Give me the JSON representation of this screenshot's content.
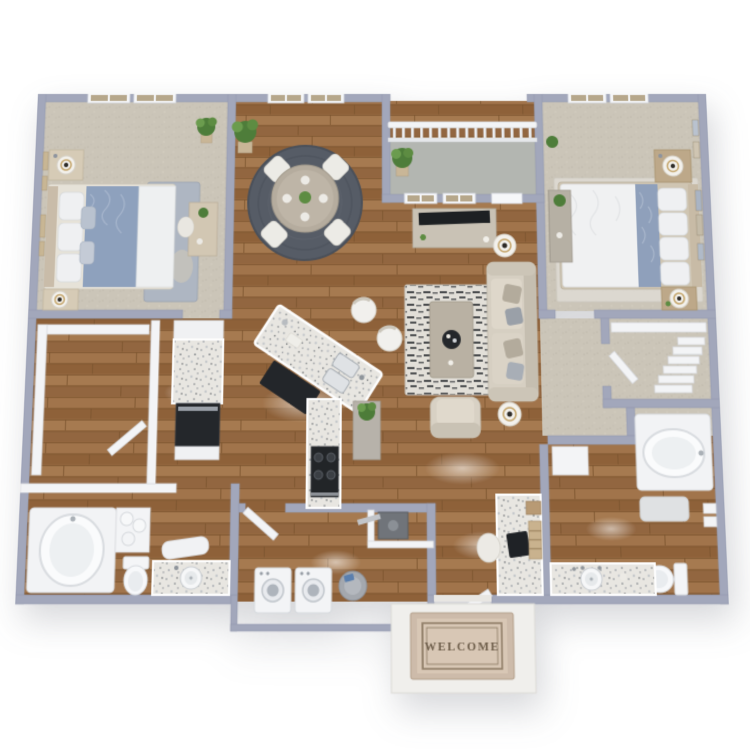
{
  "page": {
    "description": "3D isometric rendering of a two-bedroom two-bathroom apartment floor plan on a white background",
    "background_color": "#ffffff"
  },
  "floor_plan": {
    "name": "two-bed-two-bath-apartment-3d-floor-plan",
    "bedrooms": 2,
    "bathrooms": 2,
    "welcome_mat": {
      "text": "WELCOME"
    },
    "colors": {
      "exterior_wall": "#a2a7bb",
      "interior_wall": "#f3f4f6",
      "wood_floor": "#9a6c43",
      "carpet": "#cbc5b8",
      "balcony_concrete": "#b3b6b1",
      "granite_counter": "#e8e6e1",
      "dining_rug": "#565c66",
      "living_rug_dark": "#2f3236",
      "bedding_accent_blue": "#8ea1bd",
      "appliance_black": "#23262b",
      "welcome_mat_tan": "#d8c7b5",
      "plant_green": "#4e7d3a"
    },
    "rooms": [
      {
        "id": "bedroom-1",
        "name": "Bedroom 1",
        "floor": "carpet",
        "furniture": [
          "queen bed with blue accent duvet",
          "nightstand with table lamp (x2)",
          "blue area rug",
          "writing desk with chair",
          "potted plant",
          "wall art frames",
          "double windows"
        ]
      },
      {
        "id": "dining-area",
        "name": "Dining Area",
        "floor": "hardwood",
        "furniture": [
          "round dining table",
          "dining chair (x4)",
          "round braided rug",
          "greenery centerpiece",
          "potted palm",
          "double window"
        ]
      },
      {
        "id": "balcony",
        "name": "Balcony",
        "floor": "concrete",
        "furniture": [
          "white railing",
          "potted palm"
        ]
      },
      {
        "id": "bedroom-2",
        "name": "Bedroom 2",
        "floor": "carpet",
        "furniture": [
          "queen bed with blue accent runner",
          "nightstand with table lamp (x2)",
          "console desk with plant",
          "white area rug",
          "gallery wall art",
          "double windows"
        ]
      },
      {
        "id": "living-room",
        "name": "Living Room",
        "floor": "hardwood",
        "furniture": [
          "sofa with accent pillows",
          "floor lamp (x2)",
          "media console with TV",
          "black-and-white patterned rug",
          "coffee table with round tray",
          "armchair",
          "windows to balcony"
        ]
      },
      {
        "id": "kitchen",
        "name": "Kitchen",
        "floor": "hardwood",
        "furniture": [
          "angled island with double sink",
          "barstool (x2)",
          "black kitchen mat",
          "range with four burners",
          "granite perimeter counter",
          "black wall oven",
          "console table with plant"
        ]
      },
      {
        "id": "walk-in-closet-1",
        "name": "Walk-in Closet 1",
        "floor": "hardwood",
        "furniture": [
          "shelving bands",
          "open door"
        ]
      },
      {
        "id": "bathroom-1",
        "name": "Bathroom 1",
        "floor": "hardwood",
        "furniture": [
          "soaking tub",
          "rolled towels",
          "storage cabinet",
          "toilet",
          "granite vanity with sink",
          "vanity bench"
        ]
      },
      {
        "id": "laundry-room",
        "name": "Laundry Room",
        "floor": "hardwood",
        "furniture": [
          "washer",
          "dryer",
          "laundry basket",
          "utility closet with HVAC unit and duct",
          "open door"
        ]
      },
      {
        "id": "entry",
        "name": "Entry",
        "floor": "hardwood",
        "furniture": [
          "open front door",
          "exterior landing",
          "welcome mat"
        ]
      },
      {
        "id": "desk-nook",
        "name": "Desk Nook",
        "floor": "hardwood",
        "furniture": [
          "built-in granite desk",
          "laptop",
          "desk chair",
          "ladder shelf",
          "storage box"
        ]
      },
      {
        "id": "bathroom-2",
        "name": "Bathroom 2",
        "floor": "hardwood",
        "furniture": [
          "drop-in soaking tub",
          "bath mat",
          "toilet",
          "granite vanity with sink",
          "wall towels"
        ]
      },
      {
        "id": "walk-in-closet-2",
        "name": "Walk-in Closet 2",
        "floor": "carpet",
        "furniture": [
          "folded linen shelf stack",
          "top shelf",
          "open door"
        ]
      },
      {
        "id": "hallways",
        "name": "Hallways",
        "floor": "mixed carpet and hardwood",
        "furniture": []
      }
    ]
  }
}
